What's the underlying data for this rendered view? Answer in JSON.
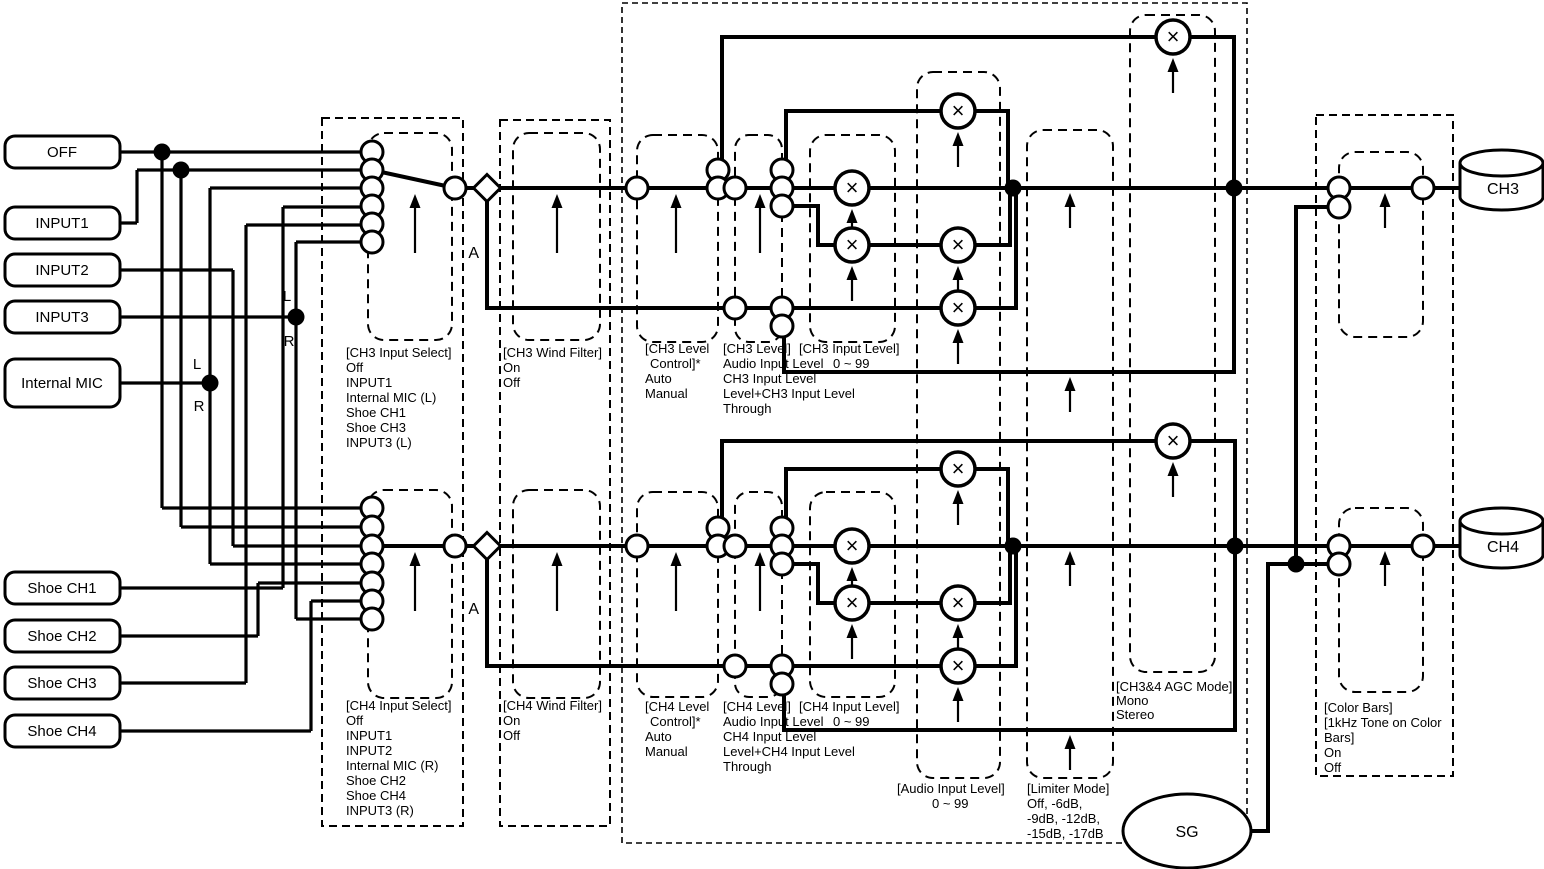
{
  "symbols": {
    "multiply": "×"
  },
  "sources": [
    "OFF",
    "INPUT1",
    "INPUT2",
    "INPUT3",
    "Internal MIC",
    "Shoe CH1",
    "Shoe CH2",
    "Shoe CH3",
    "Shoe CH4"
  ],
  "tap_labels": {
    "left": "L",
    "right": "R",
    "branch_a": "A"
  },
  "outputs": {
    "ch3": "CH3",
    "ch4": "CH4",
    "generator": "SG"
  },
  "blocks": {
    "ch3_input_select": [
      "[CH3 Input Select]",
      "Off",
      "INPUT1",
      "Internal MIC (L)",
      "Shoe CH1",
      "Shoe CH3",
      "INPUT3 (L)"
    ],
    "ch4_input_select": [
      "[CH4 Input Select]",
      "Off",
      "INPUT1",
      "INPUT2",
      "Internal MIC (R)",
      "Shoe CH2",
      "Shoe CH4",
      "INPUT3 (R)"
    ],
    "ch3_wind_filter": [
      "[CH3 Wind Filter]",
      "On",
      "Off"
    ],
    "ch4_wind_filter": [
      "[CH4 Wind Filter]",
      "On",
      "Off"
    ],
    "ch3_level_control": [
      "[CH3 Level",
      "Control]*",
      "Auto",
      "Manual"
    ],
    "ch4_level_control": [
      "[CH4 Level",
      "Control]*",
      "Auto",
      "Manual"
    ],
    "ch3_level": [
      "[CH3 Level]",
      "Audio Input Level",
      "CH3 Input Level",
      "Level+CH3 Input Level",
      "Through"
    ],
    "ch4_level": [
      "[CH4 Level]",
      "Audio Input Level",
      "CH4 Input Level",
      "Level+CH4 Input Level",
      "Through"
    ],
    "ch3_input_level": [
      "[CH3 Input Level]",
      "0 ~ 99"
    ],
    "ch4_input_level": [
      "[CH4 Input Level]",
      "0 ~ 99"
    ],
    "audio_input_level": [
      "[Audio Input Level]",
      "0 ~ 99"
    ],
    "limiter_mode": [
      "[Limiter Mode]",
      "Off,  -6dB,",
      "-9dB,  -12dB,",
      "-15dB,  -17dB"
    ],
    "agc_mode": [
      "[CH3&4 AGC Mode]",
      "Mono",
      "Stereo"
    ],
    "color_bars": [
      "[Color Bars]",
      "[1kHz Tone on Color",
      "Bars]",
      "On",
      "Off"
    ]
  }
}
